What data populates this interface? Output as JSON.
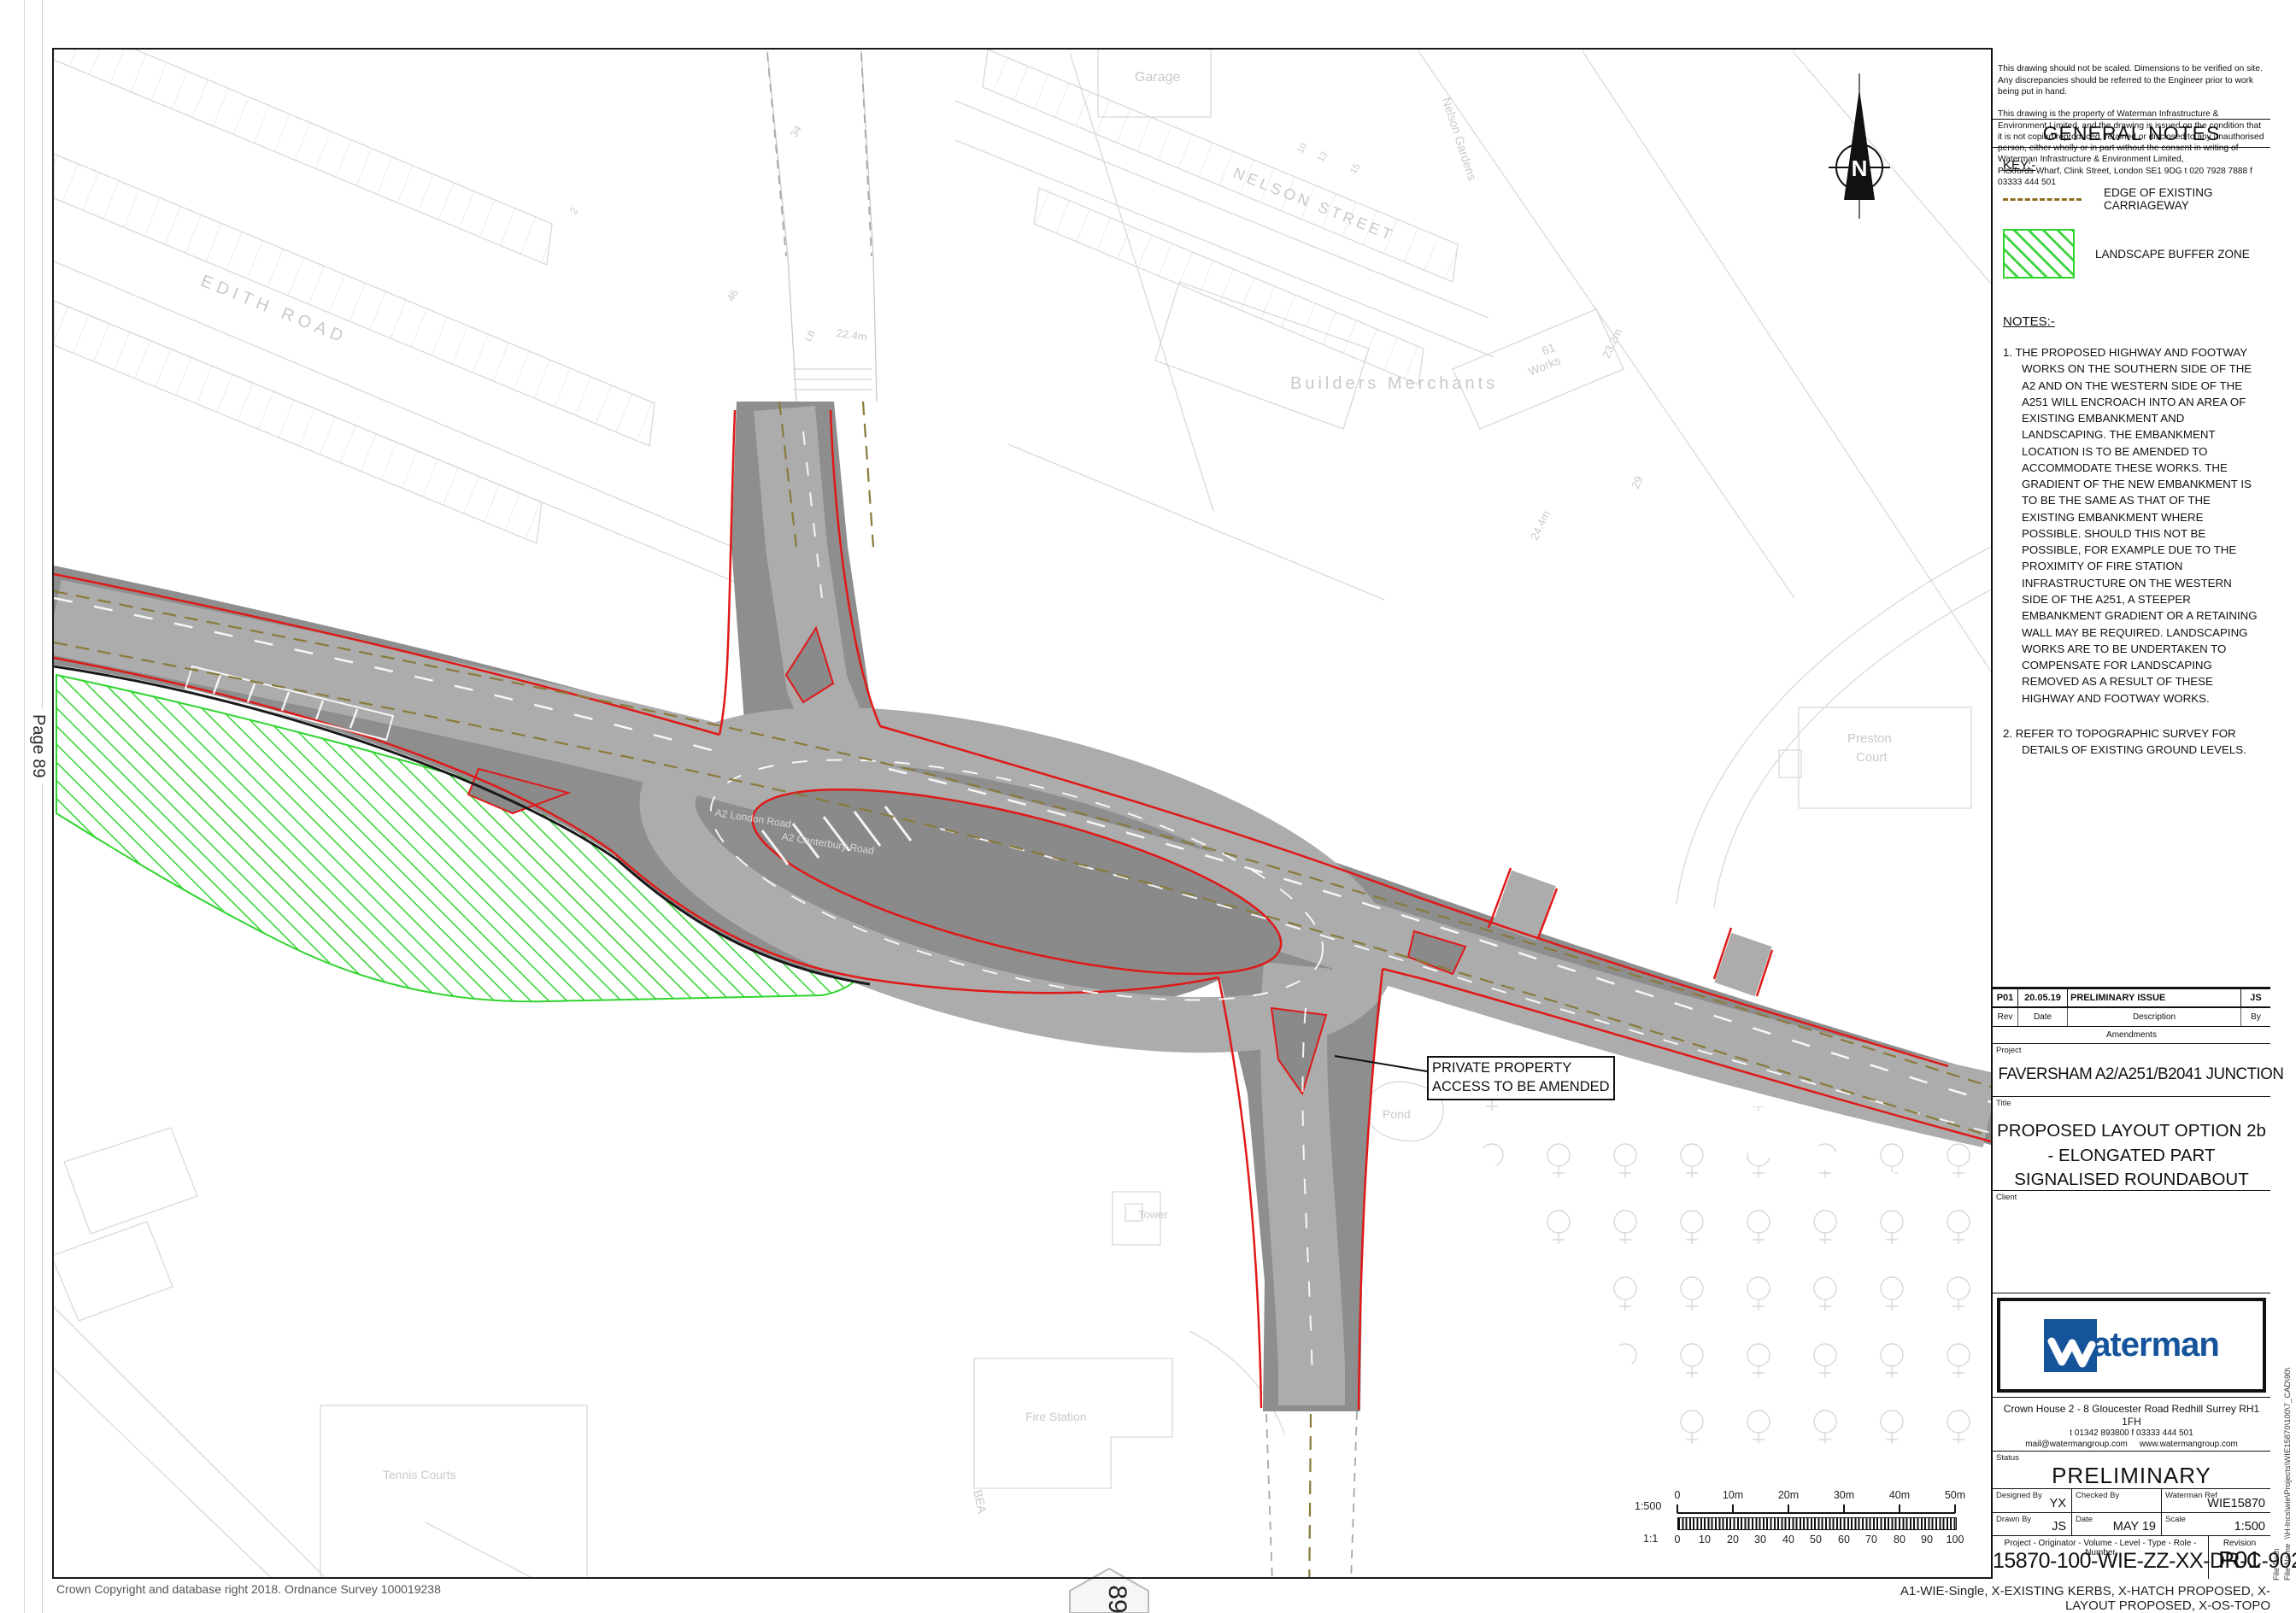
{
  "page": {
    "side_label": "Page 89",
    "tab_number": "89",
    "copyright": "Crown Copyright and database right 2018. Ordnance Survey 100019238",
    "footer_note": "A1-WIE-Single, X-EXISTING KERBS, X-HATCH PROPOSED, X-LAYOUT PROPOSED, X-OS-TOPO",
    "file_path_label": "File Path",
    "file_name_label": "File Name",
    "file_path_value": "\\\\H-lncs\\wie\\Projects\\WIE15870\\100\\7_CAD\\90\\"
  },
  "title_block": {
    "disclaimer_p1": "This drawing should not be scaled. Dimensions to be verified on site.\nAny discrepancies should be referred to the Engineer prior to work being put in hand.",
    "disclaimer_p2": "This drawing is the property of Waterman Infrastructure & Environment Limited, and the drawing is issued on the condition that it is not copied reproduced, retained or disclosed to any unauthorised person, either wholly or in part without the consent in writing of Waterman Infrastructure & Environment Limited,\nPickfords Wharf, Clink Street, London SE1 9DG   t 020 7928 7888  f 03333 444 501",
    "general_notes_title": "GENERAL NOTES",
    "key": {
      "title": "KEY:-",
      "items": [
        {
          "label": "EDGE OF EXISTING CARRIAGEWAY"
        },
        {
          "label": "LANDSCAPE BUFFER ZONE"
        }
      ]
    },
    "notes": {
      "title": "NOTES:-",
      "items": [
        "1. THE PROPOSED HIGHWAY AND FOOTWAY WORKS ON THE SOUTHERN SIDE OF THE A2 AND ON THE WESTERN SIDE OF THE A251 WILL ENCROACH INTO AN AREA OF EXISTING EMBANKMENT AND LANDSCAPING. THE EMBANKMENT LOCATION IS TO BE AMENDED TO ACCOMMODATE THESE WORKS. THE GRADIENT OF THE NEW EMBANKMENT IS TO BE THE SAME AS THAT OF THE EXISTING EMBANKMENT WHERE POSSIBLE. SHOULD THIS NOT BE POSSIBLE, FOR EXAMPLE DUE TO THE PROXIMITY OF FIRE STATION INFRASTRUCTURE ON THE WESTERN SIDE OF THE A251, A STEEPER EMBANKMENT GRADIENT OR A RETAINING WALL MAY BE REQUIRED. LANDSCAPING WORKS ARE TO BE UNDERTAKEN TO COMPENSATE FOR LANDSCAPING REMOVED AS A RESULT OF THESE HIGHWAY AND FOOTWAY WORKS.",
        "2. REFER TO TOPOGRAPHIC SURVEY FOR DETAILS OF EXISTING GROUND LEVELS."
      ]
    },
    "revision_row": {
      "rev": "P01",
      "date": "20.05.19",
      "description": "PRELIMINARY ISSUE",
      "by": "JS"
    },
    "revision_headers": {
      "rev": "Rev",
      "date": "Date",
      "description": "Description",
      "by": "By"
    },
    "amendments_label": "Amendments",
    "project_label": "Project",
    "project": "FAVERSHAM A2/A251/B2041 JUNCTION",
    "title_label": "Title",
    "title": "PROPOSED LAYOUT OPTION 2b\n- ELONGATED PART\nSIGNALISED ROUNDABOUT",
    "client_label": "Client",
    "logo_word": "aterman",
    "address": "Crown House  2 - 8 Gloucester Road  Redhill  Surrey  RH1 1FH",
    "phone": "t 01342 893800  f 03333 444 501",
    "email": "mail@watermangroup.com",
    "website": "www.watermangroup.com",
    "status_label": "Status",
    "status": "PRELIMINARY",
    "designed_by_label": "Designed By",
    "designed_by": "YX",
    "checked_by_label": "Checked By",
    "checked_by": "",
    "waterman_ref_label": "Waterman Ref",
    "waterman_ref": "WIE15870",
    "drawn_by_label": "Drawn By",
    "drawn_by": "JS",
    "date_label": "Date",
    "date": "MAY 19",
    "scale_label": "Scale",
    "scale": "1:500",
    "number_header": "Project  -  Originator  -  Volume  -  Level  -  Type  -  Role  -  Number",
    "revision_header": "Revision",
    "drawing_number": "15870-100-WIE-ZZ-XX-DR-C-90201",
    "revision": "P01"
  },
  "map": {
    "north_label": "N",
    "annotation": {
      "line1": "PRIVATE PROPERTY",
      "line2": "ACCESS TO BE AMENDED"
    },
    "scale_bar": {
      "ratio_top": "1:500",
      "ratio_bottom": "1:1",
      "top_ticks": [
        "0",
        "10m",
        "20m",
        "30m",
        "40m",
        "50m"
      ],
      "bottom_ticks": [
        "0",
        "10",
        "20",
        "30",
        "40",
        "50",
        "60",
        "70",
        "80",
        "90",
        "100"
      ]
    },
    "colors": {
      "carriageway": "#acacac",
      "verge": "#8e8e8e",
      "island": "#8a8a8a",
      "proposed_kerb": "#e01818",
      "landscape_buffer": "#2fd42f",
      "existing_edge_dash": "#8a7a3a",
      "basemap_line": "#d9d9d9"
    },
    "labels": [
      {
        "text": "EDITH ROAD"
      },
      {
        "text": "NELSON STREET"
      },
      {
        "text": "Garage"
      },
      {
        "text": "Nelson Gardens"
      },
      {
        "text": "Builders Merchants"
      },
      {
        "text": "61"
      },
      {
        "text": "Works"
      },
      {
        "text": "23.2m"
      },
      {
        "text": "24.4m"
      },
      {
        "text": "29"
      },
      {
        "text": "22.4m"
      },
      {
        "text": "LB"
      },
      {
        "text": "2"
      },
      {
        "text": "34"
      },
      {
        "text": "46"
      },
      {
        "text": "10"
      },
      {
        "text": "13"
      },
      {
        "text": "15"
      },
      {
        "text": "Preston"
      },
      {
        "text": "Court"
      },
      {
        "text": "Tower"
      },
      {
        "text": "Pond"
      },
      {
        "text": "Fire Station"
      },
      {
        "text": "Tennis Courts"
      },
      {
        "text": "BEA"
      },
      {
        "text": "A2 London Road"
      },
      {
        "text": "A2 Canterbury Road"
      }
    ]
  }
}
